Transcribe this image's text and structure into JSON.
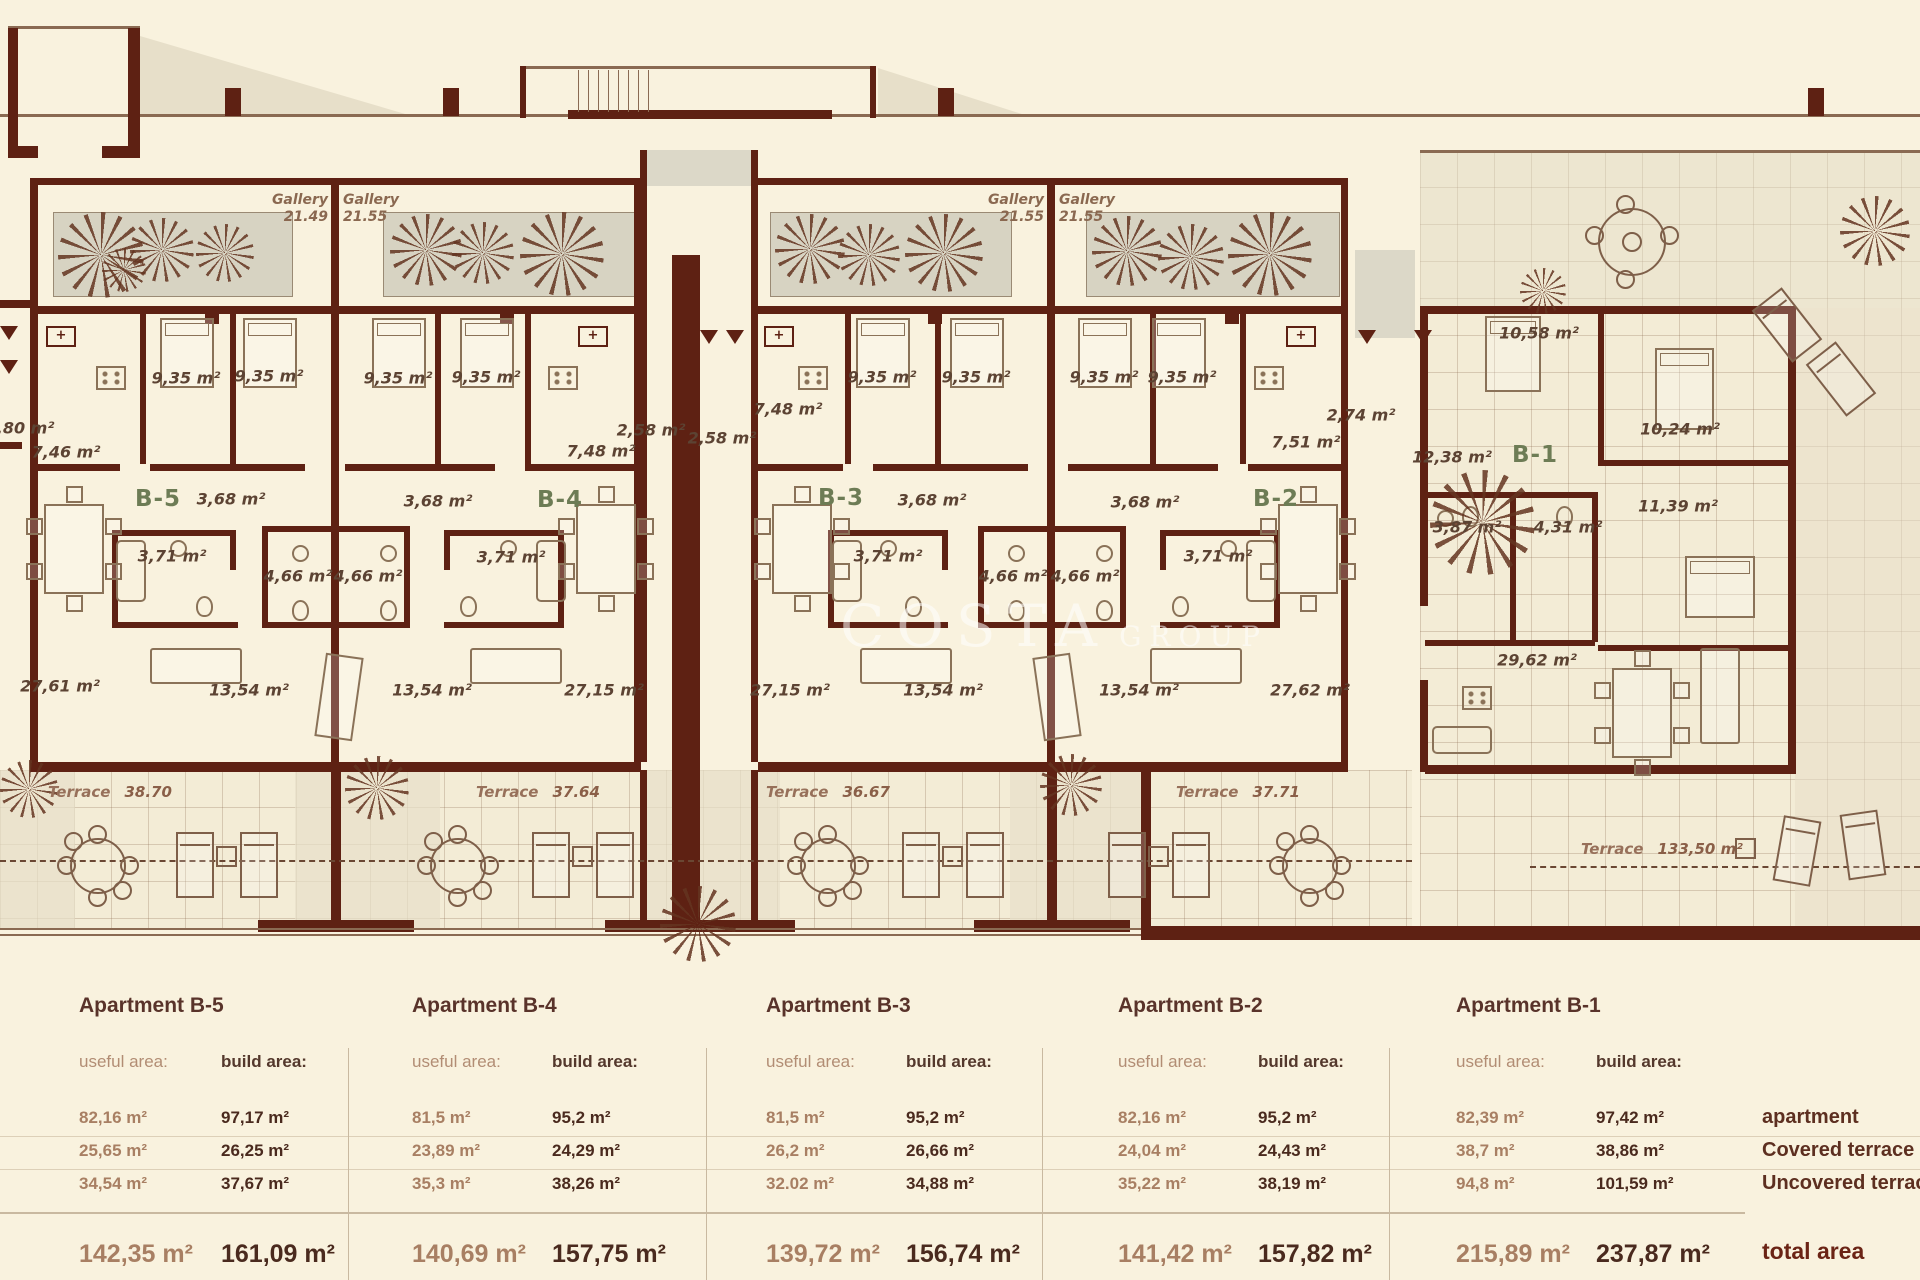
{
  "plan": {
    "galleries": [
      {
        "name": "Gallery",
        "level": "21.49"
      },
      {
        "name": "Gallery",
        "level": "21.55"
      },
      {
        "name": "Gallery",
        "level": "21.55"
      },
      {
        "name": "Gallery",
        "level": "21.55"
      }
    ],
    "apartments": [
      {
        "id": "B-5",
        "rooms": [
          "2,80 m²",
          "7,46 m²",
          "9,35 m²",
          "9,35 m²",
          "3,68 m²",
          "3,71 m²",
          "4,66 m²",
          "13,54 m²",
          "27,61 m²"
        ]
      },
      {
        "id": "B-4",
        "rooms": [
          "9,35 m²",
          "9,35 m²",
          "2,58 m²",
          "7,48 m²",
          "3,68 m²",
          "3,71 m²",
          "4,66 m²",
          "13,54 m²",
          "27,15 m²"
        ]
      },
      {
        "id": "B-3",
        "rooms": [
          "2,58 m²",
          "7,48 m²",
          "9,35 m²",
          "9,35 m²",
          "3,68 m²",
          "3,71 m²",
          "4,66 m²",
          "13,54 m²",
          "27,15 m²"
        ]
      },
      {
        "id": "B-2",
        "rooms": [
          "9,35 m²",
          "9,35 m²",
          "2,74 m²",
          "7,51 m²",
          "3,68 m²",
          "3,71 m²",
          "4,66 m²",
          "13,54 m²",
          "27,62 m²"
        ]
      },
      {
        "id": "B-1",
        "rooms": [
          "10,58 m²",
          "10,24 m²",
          "12,38 m²",
          "3,87 m²",
          "4,31 m²",
          "11,39 m²",
          "29,62 m²"
        ]
      }
    ],
    "terraces": [
      {
        "name": "Terrace",
        "area": "38.70"
      },
      {
        "name": "Terrace",
        "area": "37.64"
      },
      {
        "name": "Terrace",
        "area": "36.67"
      },
      {
        "name": "Terrace",
        "area": "37.71"
      },
      {
        "name": "Terrace",
        "area": "133,50 m²"
      }
    ],
    "watermark": [
      "COSTA",
      "GROUP"
    ]
  },
  "table": {
    "useful_header": "useful area:",
    "build_header": "build area:",
    "row_labels": [
      "apartment",
      "Covered terrace",
      "Uncovered terrace"
    ],
    "total_label": "total area",
    "apartments": [
      {
        "name": "Apartment B-5",
        "useful": [
          "82,16 m²",
          "25,65 m²",
          "34,54 m²"
        ],
        "build": [
          "97,17 m²",
          "26,25 m²",
          "37,67 m²"
        ],
        "useful_total": "142,35 m²",
        "build_total": "161,09 m²"
      },
      {
        "name": "Apartment B-4",
        "useful": [
          "81,5 m²",
          "23,89 m²",
          "35,3 m²"
        ],
        "build": [
          "95,2 m²",
          "24,29 m²",
          "38,26 m²"
        ],
        "useful_total": "140,69 m²",
        "build_total": "157,75 m²"
      },
      {
        "name": "Apartment B-3",
        "useful": [
          "81,5 m²",
          "26,2 m²",
          "32.02 m²"
        ],
        "build": [
          "95,2 m²",
          "26,66 m²",
          "34,88 m²"
        ],
        "useful_total": "139,72 m²",
        "build_total": "156,74 m²"
      },
      {
        "name": "Apartment B-2",
        "useful": [
          "82,16 m²",
          "24,04 m²",
          "35,22 m²"
        ],
        "build": [
          "95,2 m²",
          "24,43 m²",
          "38,19 m²"
        ],
        "useful_total": "141,42 m²",
        "build_total": "157,82 m²"
      },
      {
        "name": "Apartment B-1",
        "useful": [
          "82,39 m²",
          "38,7 m²",
          "94,8 m²"
        ],
        "build": [
          "97,42 m²",
          "38,86 m²",
          "101,59 m²"
        ],
        "useful_total": "215,89 m²",
        "build_total": "237,87 m²"
      }
    ]
  }
}
